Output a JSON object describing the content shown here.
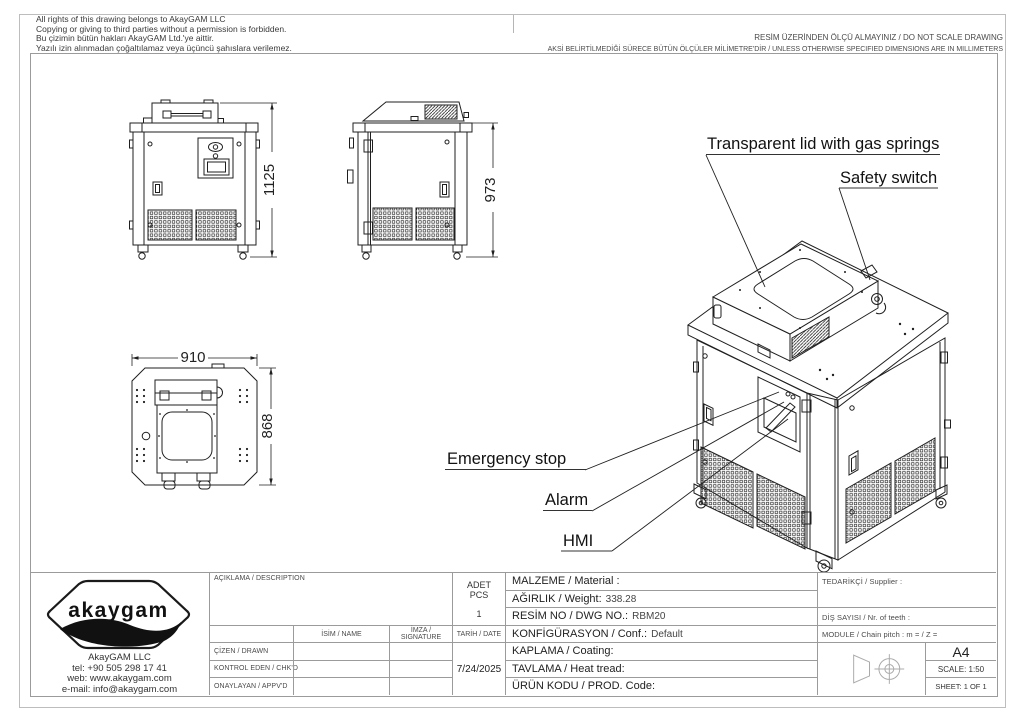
{
  "header": {
    "copyright_en": "All rights of this drawing belongs to AkayGAM LLC\nCopying or giving to third parties without a permission is forbidden.",
    "copyright_tr": "Bu çizimin bütün hakları AkayGAM Ltd.'ye aittir.\nYazılı izin alınmadan çoğaltılamaz veya üçüncü şahıslara verilemez.",
    "no_scale": "RESİM ÜZERİNDEN ÖLÇÜ ALMAYINIZ / DO NOT SCALE DRAWING",
    "units": "AKSİ BELİRTİLMEDİĞİ SÜRECE BÜTÜN ÖLÇÜLER MİLİMETRE'DİR / UNLESS OTHERWISE SPECIFIED DIMENSIONS ARE IN MILLIMETERS"
  },
  "drawing": {
    "dims": {
      "front_height": "1125",
      "side_height": "973",
      "top_width": "910",
      "top_depth": "868"
    },
    "annotations": {
      "lid": "Transparent lid with gas springs",
      "safety_switch": "Safety switch",
      "emergency_stop": "Emergency stop",
      "alarm": "Alarm",
      "hmi": "HMI"
    }
  },
  "title_block": {
    "description_label": "AÇIKLAMA / DESCRIPTION",
    "qty_label_line1": "ADET",
    "qty_label_line2": "PCS",
    "qty_value": "1",
    "name_label": "İSİM / NAME",
    "signature_label": "İMZA / SIGNATURE",
    "date_label": "TARİH / DATE",
    "drawn_label": "ÇİZEN / DRAWN",
    "checked_label": "KONTROL EDEN / CHK'D",
    "approved_label": "ONAYLAYAN / APPV'D",
    "date_value": "7/24/2025",
    "material_label": "MALZEME / Material :",
    "weight_label": "AĞIRLIK / Weight:",
    "weight_value": "338.28",
    "dwg_no_label": "RESİM NO / DWG NO.:",
    "dwg_no_value": "RBM20",
    "conf_label": "KONFİGÜRASYON / Conf.:",
    "conf_value": "Default",
    "coating_label": "KAPLAMA / Coating:",
    "heat_label": "TAVLAMA / Heat tread:",
    "prod_code_label": "ÜRÜN KODU / PROD. Code:",
    "supplier_label": "TEDARİKÇİ / Supplier :",
    "teeth_label": "DİŞ SAYISI / Nr. of teeth :",
    "module_label": "MODULE / Chain pitch :  m =    / Z =",
    "paper_size": "A4",
    "scale_label": "SCALE: 1:50",
    "sheet_label": "SHEET: 1 OF 1"
  },
  "logo": {
    "brand": "akaygam",
    "company": "AkayGAM LLC",
    "tel": "tel: +90 505 298 17 41",
    "web": "web: www.akaygam.com",
    "email": "e-mail: info@akaygam.com"
  }
}
